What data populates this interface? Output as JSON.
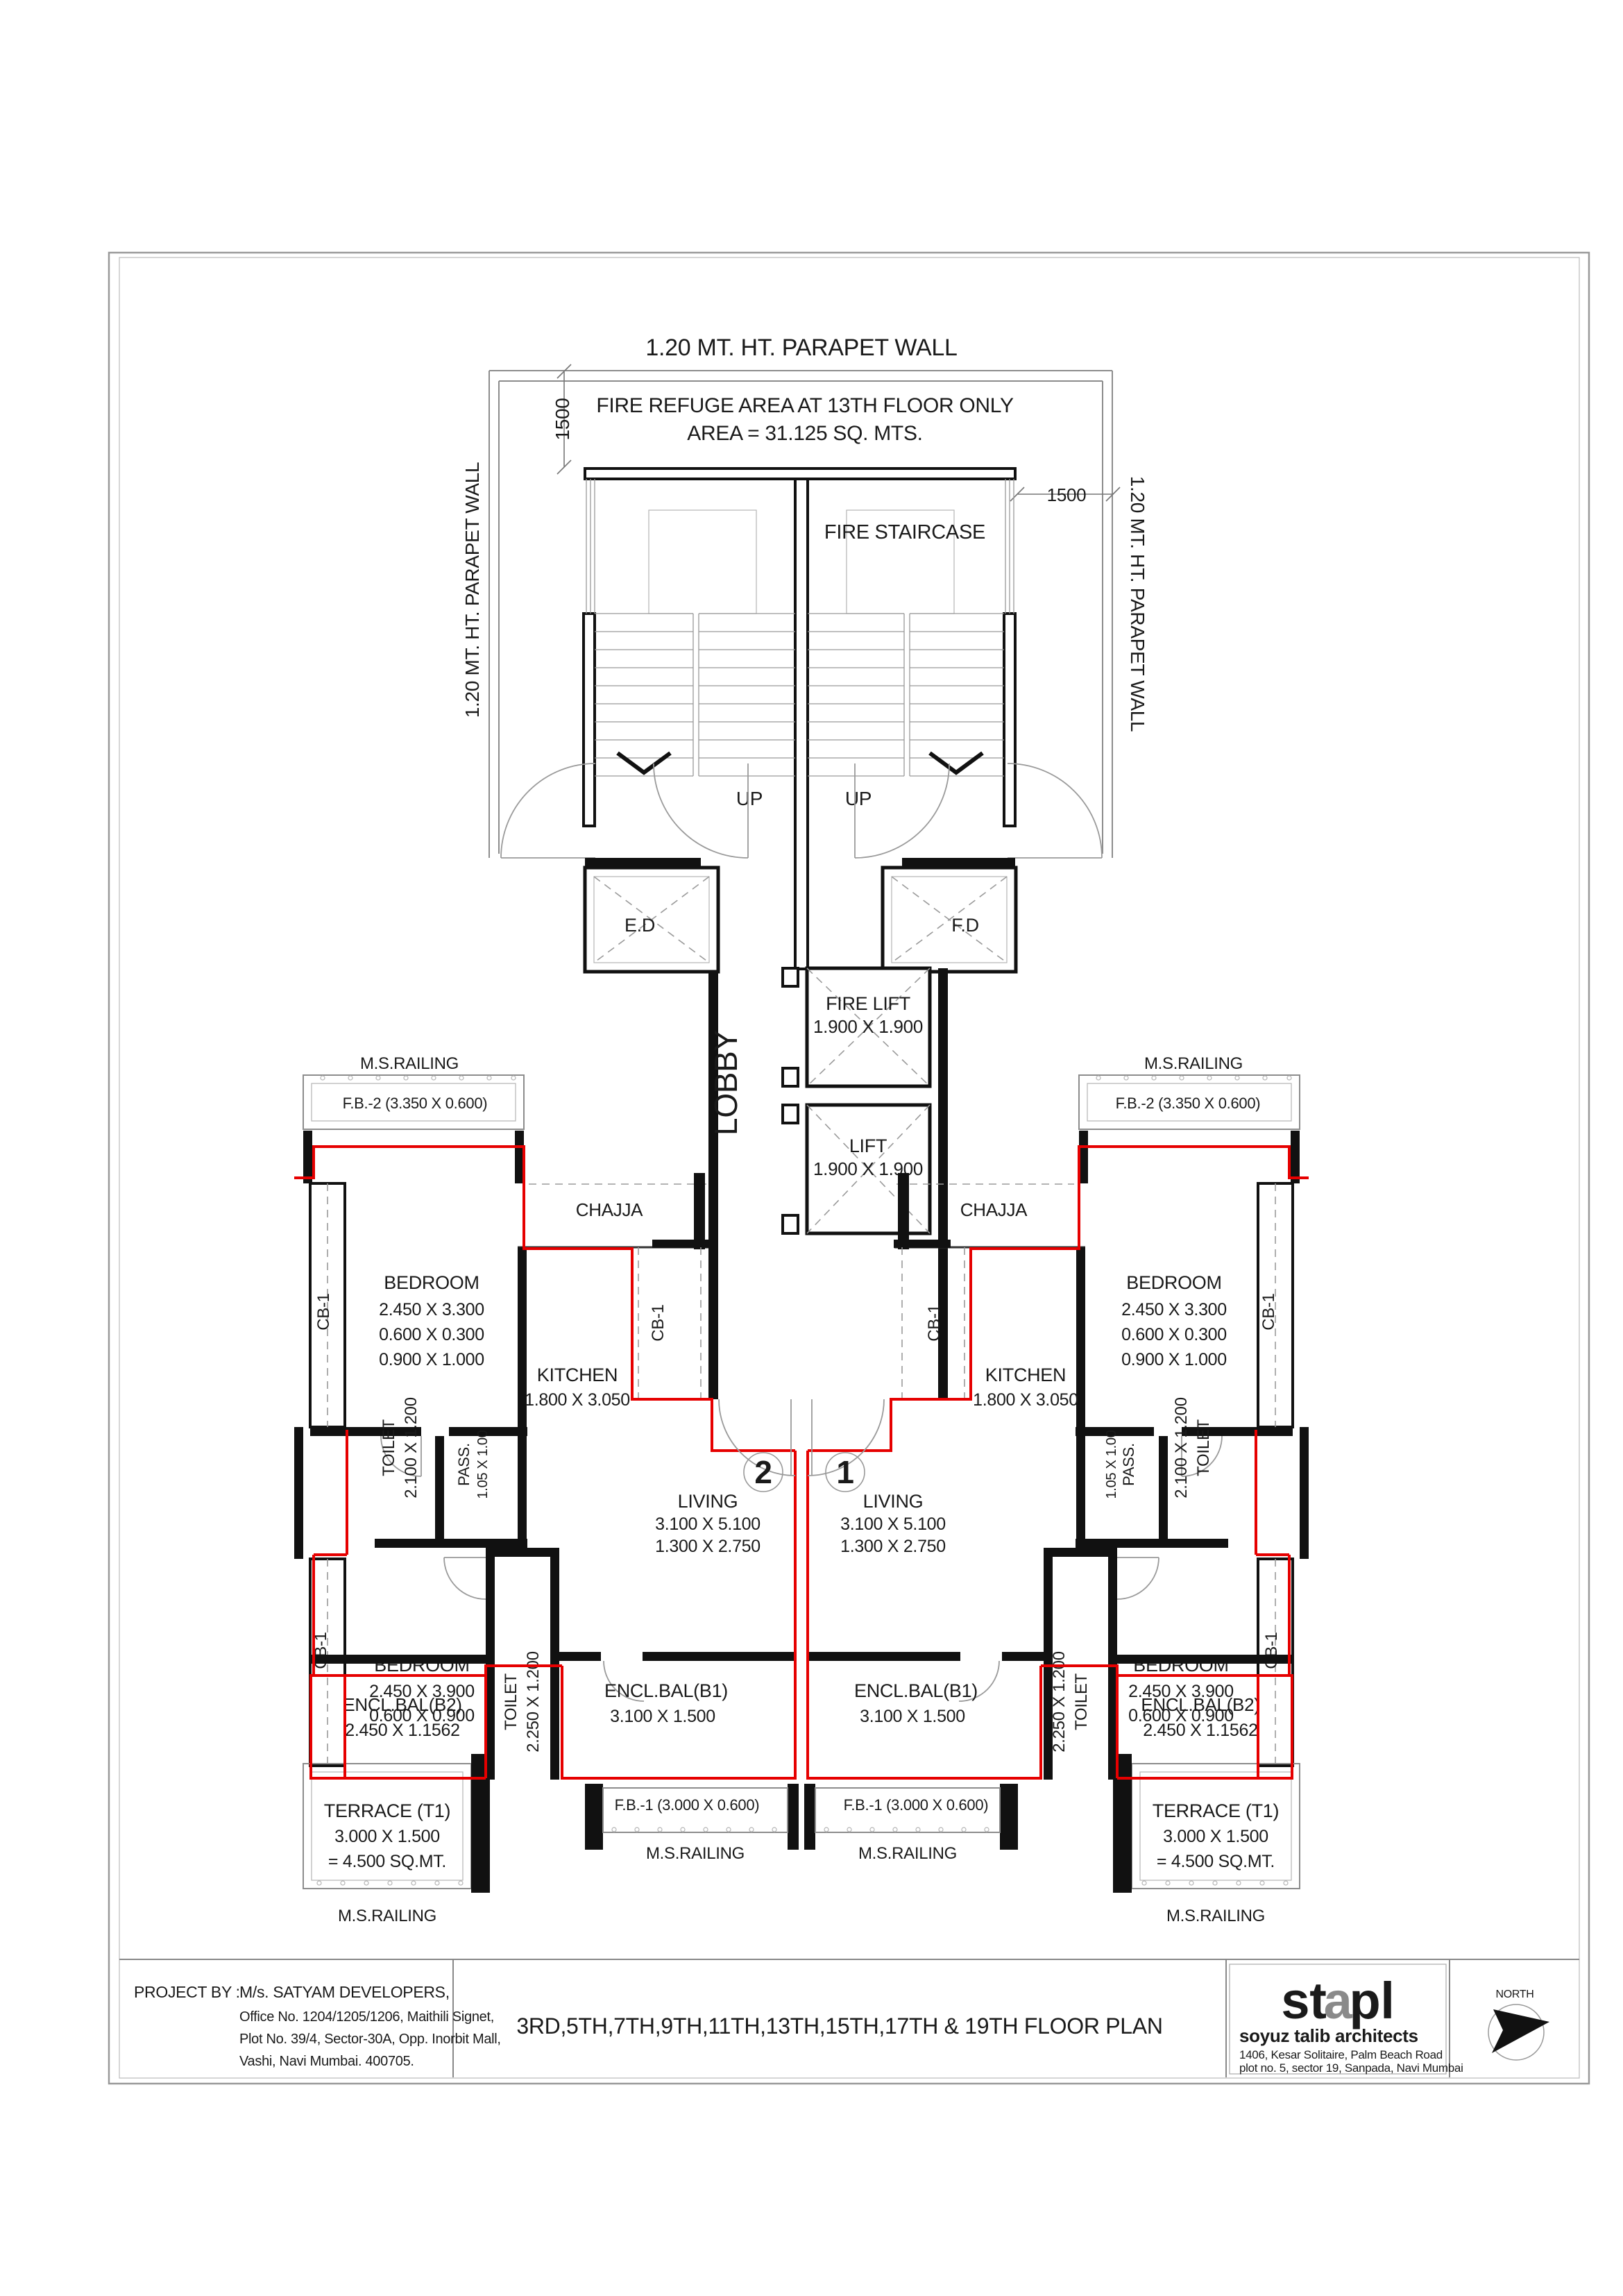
{
  "colors": {
    "flat_outline": "#e60000",
    "wall": "#111111",
    "thin_line": "#8c8c8c"
  },
  "top": {
    "parapet_top": "1.20 MT. HT. PARAPET WALL",
    "parapet_left": "1.20 MT. HT. PARAPET WALL",
    "parapet_right": "1.20 MT. HT. PARAPET WALL",
    "refuge_line1": "FIRE REFUGE AREA AT 13TH FLOOR ONLY",
    "refuge_line2": "AREA = 31.125 SQ. MTS.",
    "dim_left": "1500",
    "dim_right": "1500",
    "fire_staircase": "FIRE STAIRCASE",
    "up": "UP"
  },
  "core": {
    "ed": "E.D",
    "fd": "F.D",
    "fire_lift": "FIRE LIFT",
    "fire_lift_size": "1.900 X 1.900",
    "lift": "LIFT",
    "lift_size": "1.900 X 1.900",
    "lobby": "LOBBY",
    "chajja": "CHAJJA",
    "cb1": "CB-1"
  },
  "flats": {
    "flat1_no": "1",
    "flat2_no": "2",
    "living": "LIVING",
    "living_dim1": "3.100 X 5.100",
    "living_dim2": "1.300 X 2.750"
  },
  "rooms": {
    "ms_railing": "M.S.RAILING",
    "fb2": "F.B.-2 (3.350 X 0.600)",
    "fb1": "F.B.-1 (3.000 X 0.600)",
    "bedroom": "BEDROOM",
    "bedroom1_dim1": "2.450 X 3.300",
    "bedroom1_dim2": "0.600 X 0.300",
    "bedroom1_dim3": "0.900 X 1.000",
    "bedroom2_dim1": "2.450 X 3.900",
    "bedroom2_dim2": "0.600 X 0.900",
    "kitchen": "KITCHEN",
    "kitchen_dim": "1.800 X 3.050",
    "toilet": "TOILET",
    "toilet1_dim": "2.100 X 1.200",
    "toilet2_dim": "2.250 X 1.200",
    "pass": "PASS.",
    "pass_dim": "1.05 X 1.00",
    "encl_b1": "ENCL.BAL(B1)",
    "encl_b1_dim": "3.100 X 1.500",
    "encl_b2": "ENCL.BAL(B2)",
    "encl_b2_dim": "2.450 X 1.1562",
    "terrace": "TERRACE (T1)",
    "terrace_dim": "3.000 X 1.500",
    "terrace_area": "= 4.500 SQ.MT."
  },
  "title_block": {
    "project_by": "PROJECT BY :",
    "developer": "M/s. SATYAM DEVELOPERS,",
    "addr1": "Office No. 1204/1205/1206, Maithili Signet,",
    "addr2": "Plot No. 39/4, Sector-30A, Opp. Inorbit Mall,",
    "addr3": "Vashi, Navi Mumbai. 400705.",
    "title": "3RD,5TH,7TH,9TH,11TH,13TH,15TH,17TH & 19TH FLOOR PLAN",
    "logo_st": "st",
    "logo_a": "a",
    "logo_pl": "pl",
    "firm": "soyuz  talib  architects",
    "firm_addr1": "1406, Kesar Solitaire, Palm Beach Road",
    "firm_addr2": "plot no. 5, sector 19, Sanpada, Navi Mumbai",
    "north": "NORTH"
  }
}
